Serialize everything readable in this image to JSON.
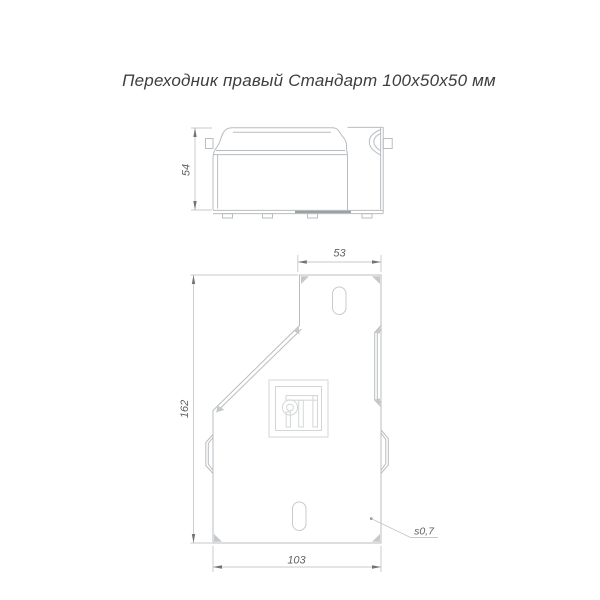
{
  "title": "Переходник правый Стандарт 100х50х50 мм",
  "views": {
    "side": {
      "label": "side-profile-view",
      "dims": {
        "height": "54"
      }
    },
    "plan": {
      "label": "plan-view",
      "dims": {
        "top_width": "53",
        "left_height": "162",
        "bottom_width": "103",
        "thickness": "s0,7"
      }
    }
  },
  "icons": {
    "logo": "manufacturer-logo"
  },
  "colors": {
    "background": "#ffffff",
    "outline": "#b9bdbf",
    "outline_strong": "#9ba0a2",
    "dimension_line": "#c6c9cb",
    "arrow": "#70757a",
    "dimension_text": "#5f6467",
    "title_text": "#3e3e3e",
    "logo_line": "#d3d6d7"
  }
}
